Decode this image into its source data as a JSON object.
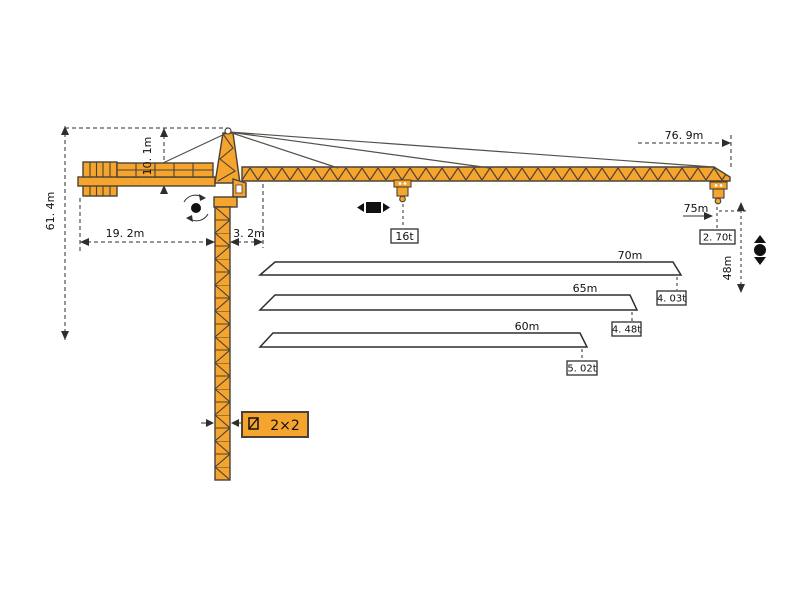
{
  "meta": {
    "title": "Tower crane dimension and load diagram"
  },
  "colors": {
    "crane": "#F5A42D",
    "outline": "#4A4238",
    "line": "#2E2E2E",
    "text": "#111111",
    "background": "#FFFFFF"
  },
  "labels": {
    "total_height": "61. 4m",
    "head_height": "10. 1m",
    "counter_jib_length": "19. 2m",
    "jib_root_offset": "3. 2m",
    "overall_radius": "76. 9m",
    "tip_radius": "75m",
    "tip_load": "2. 70t",
    "hook_height": "48m",
    "max_load": "16t",
    "mast_section": "2×2"
  },
  "load_chart": {
    "bars": [
      {
        "length": "70m",
        "capacity": "4. 03t"
      },
      {
        "length": "65m",
        "capacity": "4. 48t"
      },
      {
        "length": "60m",
        "capacity": "5. 02t"
      }
    ]
  },
  "chart_data": {
    "type": "bar",
    "title": "Tip capacity by jib length",
    "categories": [
      "70m",
      "65m",
      "60m"
    ],
    "values": [
      4.03,
      4.48,
      5.02
    ],
    "unit": "t",
    "annotations": {
      "max_load_t": 16,
      "load_at_75m_t": 2.7,
      "hook_height_m": 48,
      "overall_radius_m": 76.9,
      "total_height_m": 61.4,
      "head_height_m": 10.1,
      "counter_jib_m": 19.2,
      "jib_root_offset_m": 3.2,
      "mast_section": "2×2"
    },
    "layout": {
      "orientation": "horizontal-trapezoid-bars",
      "grid": false,
      "legend": false
    }
  },
  "icons": {
    "slewing": "rotation-arrows-around-dot",
    "trolley_travel": "black-square-with-left-right-arrows",
    "hoisting": "black-dot-with-up-down-arrows",
    "mast_section_symbol": "small-square-with-diagonal"
  }
}
